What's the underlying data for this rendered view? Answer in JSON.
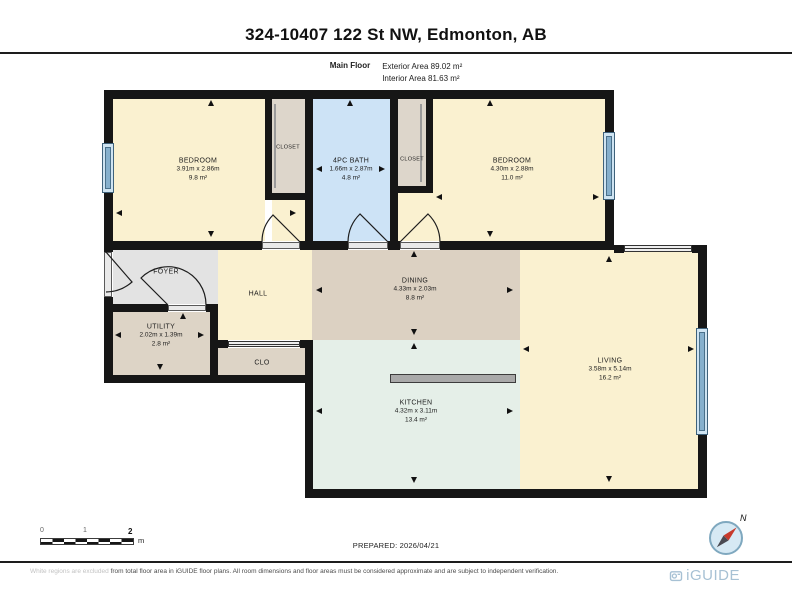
{
  "header": {
    "title": "324-10407 122 St NW, Edmonton, AB",
    "floor_label": "Main Floor",
    "exterior_area": "Exterior Area 89.02 m²",
    "interior_area": "Interior Area 81.63 m²"
  },
  "rooms": {
    "bedroom1": {
      "name": "BEDROOM",
      "dims": "3.91m x 2.86m",
      "area": "9.8 m²"
    },
    "closet1": {
      "name": "CLOSET"
    },
    "bath": {
      "name": "4PC BATH",
      "dims": "1.66m x 2.87m",
      "area": "4.8 m²"
    },
    "closet2": {
      "name": "CLOSET"
    },
    "bedroom2": {
      "name": "BEDROOM",
      "dims": "4.30m x 2.88m",
      "area": "11.0 m²"
    },
    "foyer": {
      "name": "FOYER"
    },
    "hall": {
      "name": "HALL"
    },
    "dining": {
      "name": "DINING",
      "dims": "4.33m x 2.03m",
      "area": "8.8 m²"
    },
    "utility": {
      "name": "UTILITY",
      "dims": "2.02m x 1.39m",
      "area": "2.8 m²"
    },
    "clo": {
      "name": "CLO"
    },
    "kitchen": {
      "name": "KITCHEN",
      "dims": "4.32m x 3.11m",
      "area": "13.4 m²"
    },
    "living": {
      "name": "LIVING",
      "dims": "3.58m x 5.14m",
      "area": "16.2 m²"
    }
  },
  "scale": {
    "tick0": "0",
    "tick1": "1",
    "tick2": "2",
    "unit": "m"
  },
  "prepared": "PREPARED: 2026/04/21",
  "compass": {
    "north_label": "N"
  },
  "footer": {
    "disclaimer_light": "White regions are excluded",
    "disclaimer_dark": " from total floor area in iGUIDE floor plans. All room dimensions and floor areas must be considered approximate and are subject to independent verification.",
    "brand": "iGUIDE"
  },
  "colors": {
    "wall": "#161616",
    "room_cream": "#faf1d0",
    "bath_blue": "#cde3f6",
    "closet_grey": "#ddd6cb",
    "foyer_grey": "#e3e3e3",
    "dining_tan": "#dcd1c2",
    "kitchen_green": "#e5efe8",
    "window_blue": "#86b0cd",
    "brand_blue": "#a7c1d4",
    "compass_red": "#c73a2c"
  }
}
